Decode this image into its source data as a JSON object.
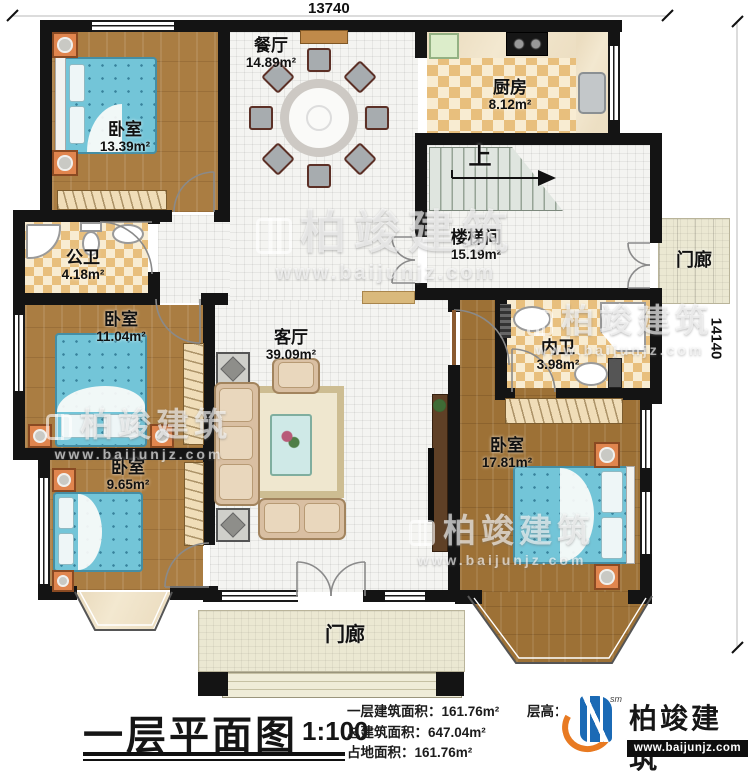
{
  "dimensions": {
    "top": "13740",
    "right": "14140"
  },
  "rooms": {
    "bedroom_tl": {
      "name": "卧室",
      "area": "13.39m²"
    },
    "dining": {
      "name": "餐厅",
      "area": "14.89m²"
    },
    "kitchen": {
      "name": "厨房",
      "area": "8.12m²"
    },
    "stairwell": {
      "name": "楼梯间",
      "area": "15.19m²"
    },
    "stairs_up_label": "上",
    "porch_right": {
      "name": "门廊"
    },
    "bath_public": {
      "name": "公卫",
      "area": "4.18m²"
    },
    "bedroom_ml": {
      "name": "卧室",
      "area": "11.04m²"
    },
    "bedroom_bl": {
      "name": "卧室",
      "area": "9.65m²"
    },
    "living": {
      "name": "客厅",
      "area": "39.09m²"
    },
    "bath_inner": {
      "name": "内卫",
      "area": "3.98m²"
    },
    "bedroom_br": {
      "name": "卧室",
      "area": "17.81m²"
    },
    "porch_bottom": {
      "name": "门廊"
    }
  },
  "watermark": {
    "brand": "柏竣建筑",
    "url": "www.baijunjz.com"
  },
  "footer": {
    "title": "一层平面图",
    "scale": "1:100",
    "stats": [
      {
        "label": "一层建筑面积：",
        "value": "161.76m²"
      },
      {
        "label": "总建筑面积：",
        "value": "647.04m²"
      },
      {
        "label": "占地面积：",
        "value": "161.76m²"
      }
    ],
    "floor_height_label": "层高：",
    "logo": {
      "brand": "柏竣建筑",
      "url": "www.baijunjz.com",
      "mark": "sm"
    }
  },
  "colors": {
    "wall": "#141414",
    "wood": "#aa7d42",
    "bed": "#73c5d8",
    "logo_blue": "#1b6ab5",
    "logo_orange": "#e87a22"
  }
}
